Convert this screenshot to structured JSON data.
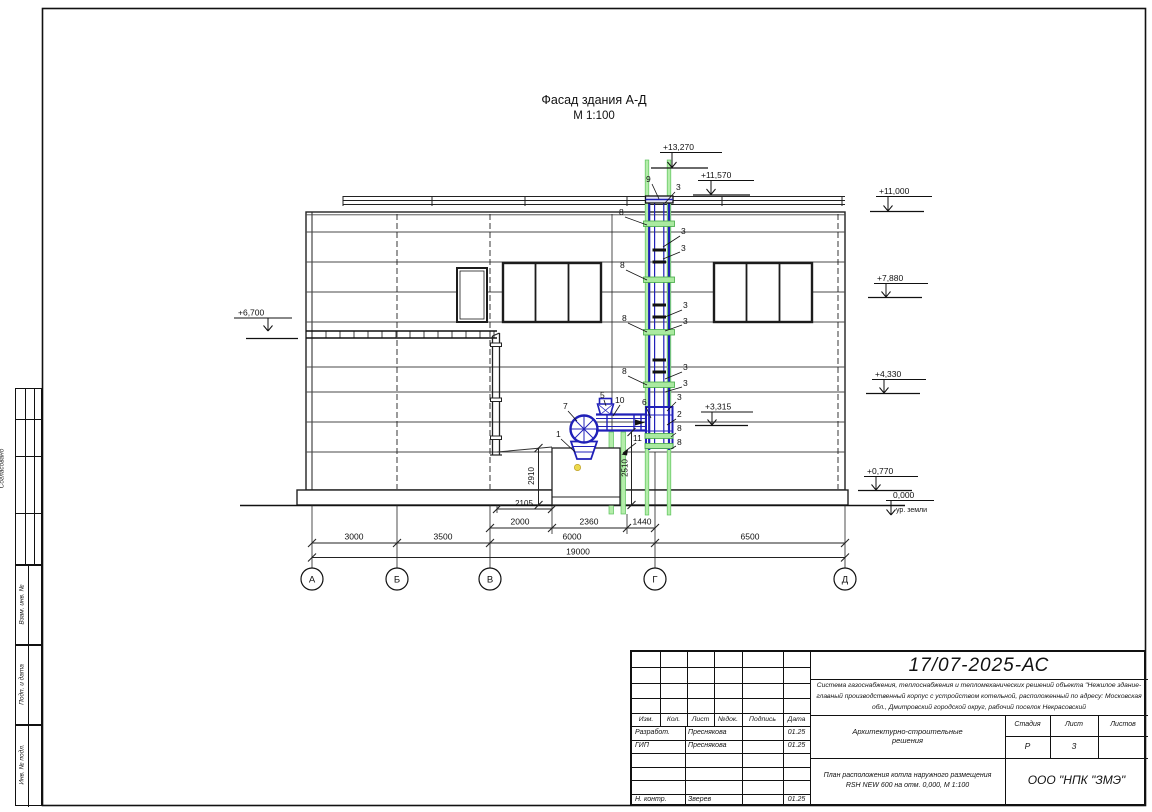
{
  "drawing": {
    "title": "Фасад здания А-Д",
    "scale": "М 1:100",
    "axes": [
      "А",
      "Б",
      "В",
      "Г",
      "Д"
    ],
    "elevations": {
      "e13270": "+13,270",
      "e11570": "+11,570",
      "e11000": "+11,000",
      "e7880": "+7,880",
      "e4330": "+4,330",
      "e3315": "+3,315",
      "e6700": "+6,700",
      "e0770": "+0,770",
      "e0000": "0,000",
      "ground": "ур. земли"
    },
    "dims": {
      "d3000": "3000",
      "d3500": "3500",
      "d6000": "6000",
      "d6500": "6500",
      "d19000": "19000",
      "d2000": "2000",
      "d2360": "2360",
      "d1440": "1440",
      "d2105": "2105",
      "d2910": "2910",
      "d2510": "2510"
    },
    "callouts": {
      "c1": "1",
      "c2": "2",
      "c3": "3",
      "c5": "5",
      "c6": "6",
      "c7": "7",
      "c8": "8",
      "c9": "9",
      "c10": "10",
      "c11": "11"
    }
  },
  "left_margin": {
    "agreed": "Согласовано",
    "vzam": "Взам. инв. №",
    "podp": "Подп. и дата",
    "inv": "Инв. № подл."
  },
  "title_block": {
    "doc_number": "17/07-2025-АС",
    "description": "Система газоснабжения, теплоснабжения и тепломеханических решений объекта \"Нежилое здание-главный производственный корпус с устройством котельной, расположенный по адресу: Московская обл., Дмитровский городской округ, рабочий поселок Некрасовский",
    "columns": [
      "Изм.",
      "Кол.",
      "Лист",
      "№док.",
      "Подпись",
      "Дата"
    ],
    "rows": [
      {
        "role": "Разработ.",
        "name": "Преснякова",
        "date": "01.25"
      },
      {
        "role": "ГИП",
        "name": "Преснякова",
        "date": "01.25"
      },
      {
        "role": "",
        "name": "",
        "date": ""
      },
      {
        "role": "",
        "name": "",
        "date": ""
      },
      {
        "role": "",
        "name": "",
        "date": ""
      },
      {
        "role": "Н. контр.",
        "name": "Зверев",
        "date": "01.25"
      }
    ],
    "section_title_line1": "Архитектурно-строительные",
    "section_title_line2": "решения",
    "sheet_title_line1": "План расположения котла наружного размещения",
    "sheet_title_line2": "RSH NEW 600 на отм. 0,000,  М 1:100",
    "stage_label": "Стадия",
    "sheet_label": "Лист",
    "sheets_label": "Листов",
    "stage": "Р",
    "sheet_num": "3",
    "company": "ООО \"НПК \"ЗМЭ\""
  },
  "colors": {
    "pipe": "#2020b8",
    "support_fill": "#aaeaa0",
    "support_edge": "#44aa44",
    "dot": "#ecd94d"
  }
}
